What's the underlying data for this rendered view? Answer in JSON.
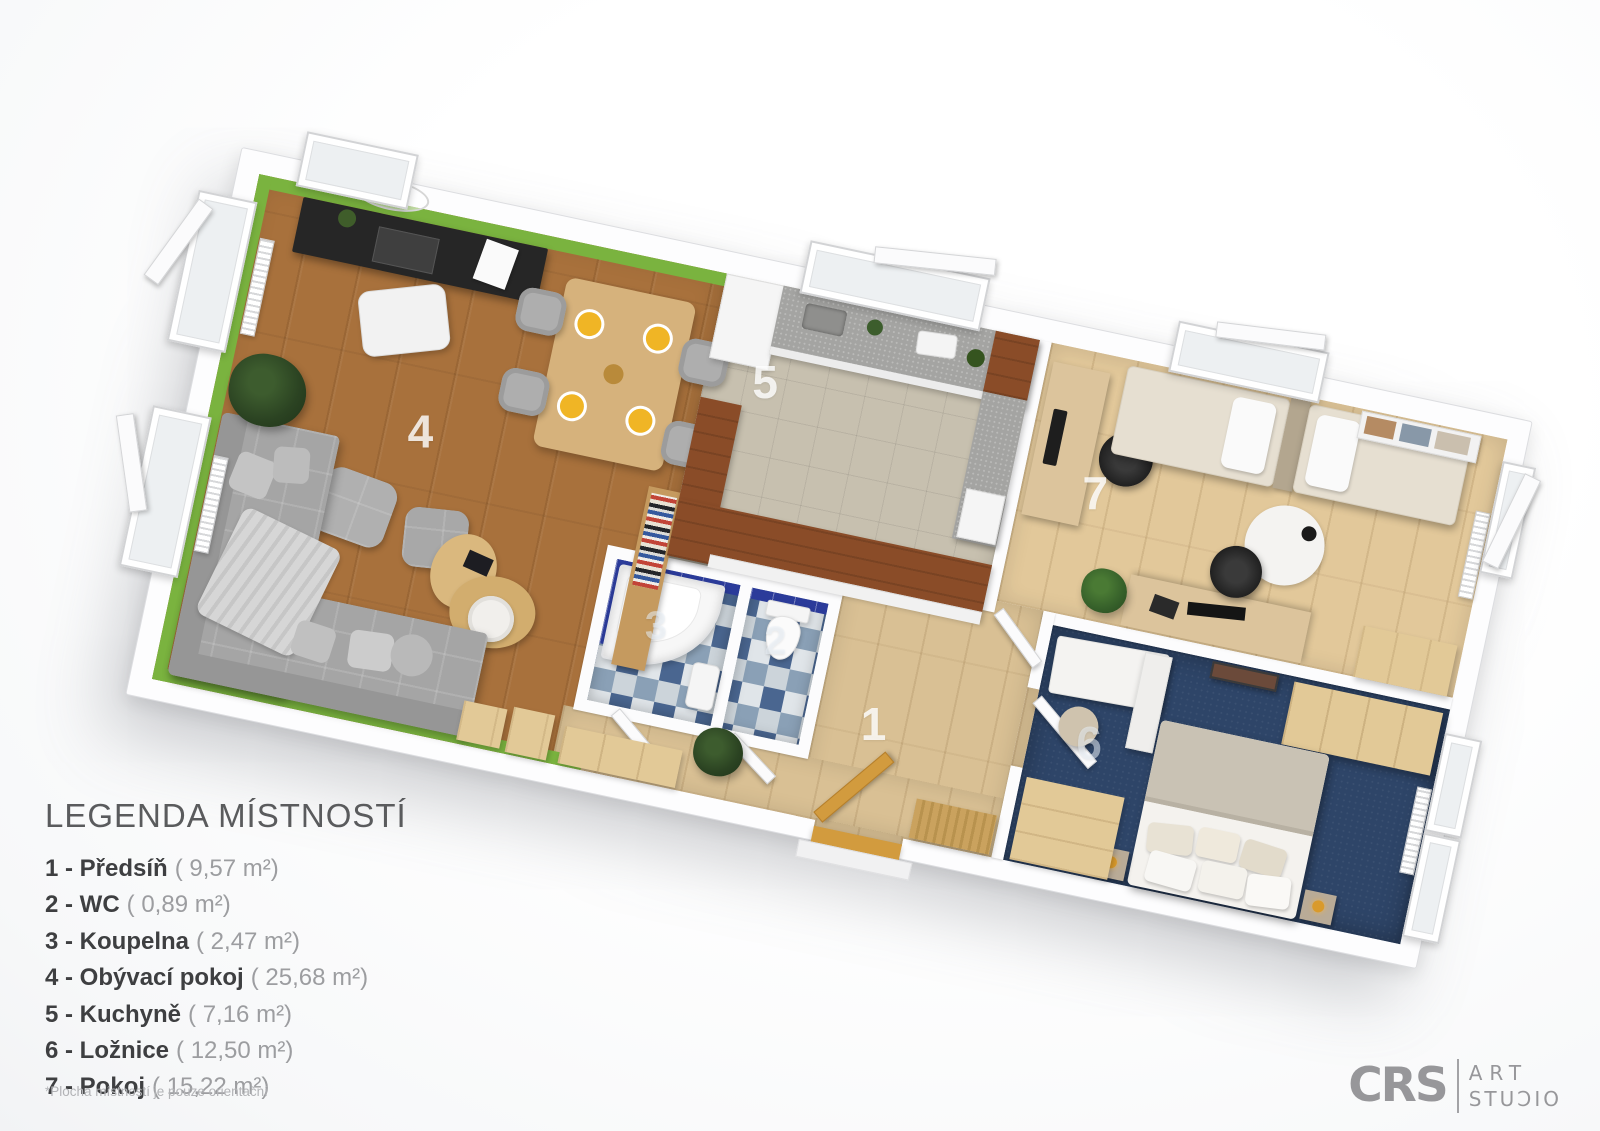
{
  "plan": {
    "rotation_deg": 12,
    "colors": {
      "accent_green": "#7ab33f",
      "living_wood": "#a8713c",
      "parquet_light": "#d9c094",
      "kitchen_tile": "#c7c0af",
      "bedroom_navy": "#2e4568",
      "bath_tile_blue": "#2b3b9a",
      "bar_counter_wood": "#8a4c28",
      "sofa_gray": "#a5a5a5",
      "wall_white": "#fdfdfe"
    }
  },
  "legend": {
    "title": "LEGENDA MÍSTNOSTÍ",
    "items": [
      {
        "number": "1",
        "label": "1 - Předsíň",
        "area": "( 9,57 m²)"
      },
      {
        "number": "2",
        "label": "2 - WC",
        "area": "( 0,89 m²)"
      },
      {
        "number": "3",
        "label": "3 - Koupelna",
        "area": "( 2,47 m²)"
      },
      {
        "number": "4",
        "label": "4 - Obývací pokoj",
        "area": "( 25,68 m²)"
      },
      {
        "number": "5",
        "label": "5 - Kuchyně",
        "area": "( 7,16 m²)"
      },
      {
        "number": "6",
        "label": "6 - Ložnice",
        "area": "( 12,50 m²)"
      },
      {
        "number": "7",
        "label": "7 - Pokoj",
        "area": "( 15,22 m²)"
      }
    ],
    "footnote": "*Plocha místností je pouze orientační"
  },
  "logo": {
    "mark": "CRS",
    "line1": "ART",
    "line2": "STUƆIO"
  }
}
